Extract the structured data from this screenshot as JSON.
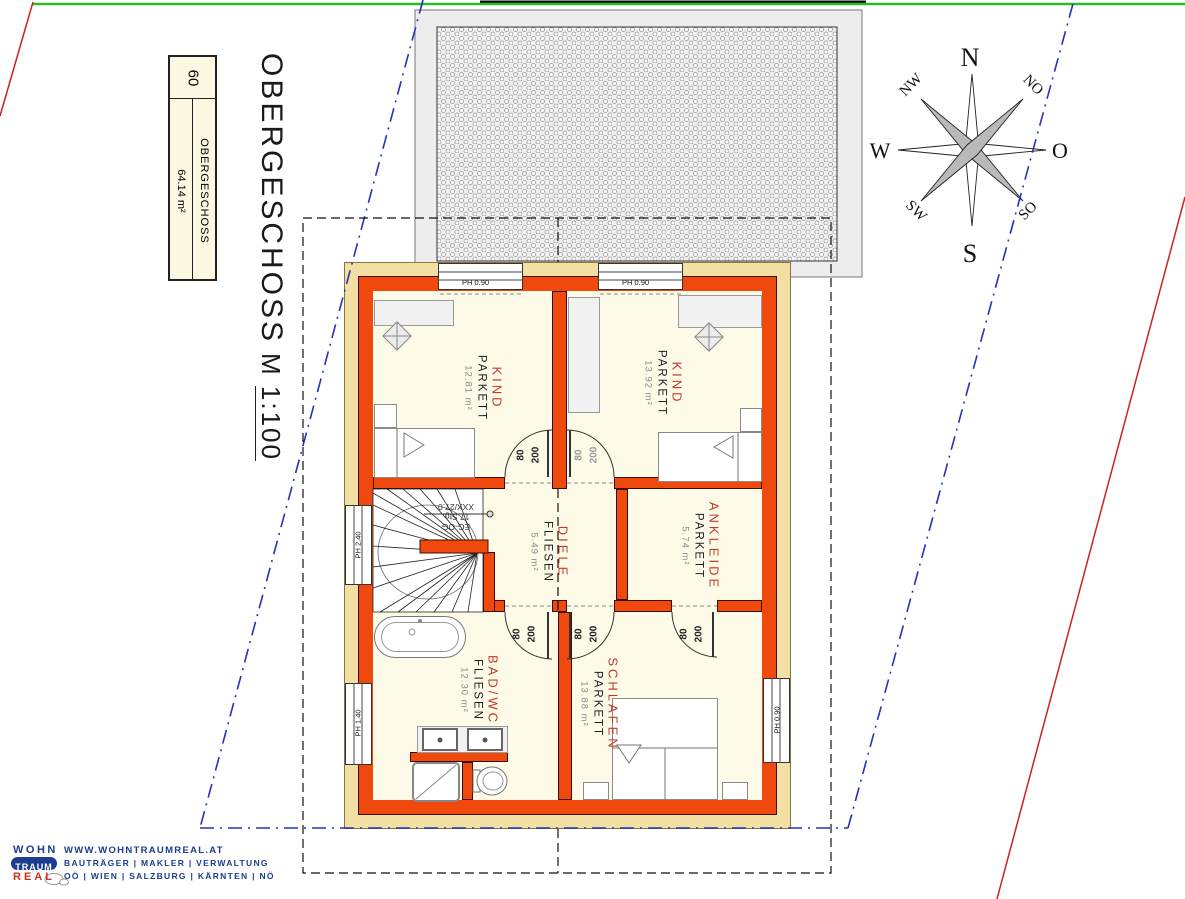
{
  "page": {
    "big_title": "OBERGESCHOSS",
    "scale_prefix": "M ",
    "scale_value": "1:100"
  },
  "title_box": {
    "number": "60",
    "name": "OBERGESCHOSS",
    "area": "64.14 m²"
  },
  "rooms": [
    {
      "name": "KIND",
      "material": "PARKETT",
      "area": "12.81 m²"
    },
    {
      "name": "KIND",
      "material": "PARKETT",
      "area": "13.92 m²"
    },
    {
      "name": "DIELE",
      "material": "FLIESEN",
      "area": "5.49 m²"
    },
    {
      "name": "ANKLEIDE",
      "material": "PARKETT",
      "area": "5.74 m²"
    },
    {
      "name": "BAD/WC",
      "material": "FLIESEN",
      "area": "12.30 m²"
    },
    {
      "name": "SCHLAFEN",
      "material": "PARKETT",
      "area": "13.88 m²"
    }
  ],
  "windows": [
    {
      "label": "PH 0.90"
    },
    {
      "label": "PH 0.90"
    },
    {
      "label": "PH 2.40"
    },
    {
      "label": "PH 1.40"
    },
    {
      "label": "PH 0.90"
    }
  ],
  "doors": [
    {
      "width": "80",
      "height": "200"
    },
    {
      "width": "80",
      "height": "200"
    },
    {
      "width": "80",
      "height": "200"
    },
    {
      "width": "80",
      "height": "200"
    },
    {
      "width": "80",
      "height": "200"
    }
  ],
  "stairs": {
    "line1": "EG-OG",
    "line2": "17 Stg.",
    "line3": "XXX/27.0"
  },
  "compass": {
    "n": "N",
    "no": "NO",
    "o": "O",
    "so": "SO",
    "s": "S",
    "sw": "SW",
    "w": "W",
    "nw": "NW"
  },
  "footer": {
    "logo_line1": "WOHN",
    "logo_line2": "TRAUM",
    "logo_line3": "REAL",
    "website": "WWW.WOHNTRAUMREAL.AT",
    "services": "BAUTRÄGER | MAKLER | VERWALTUNG",
    "regions": "OÖ | WIEN | SALZBURG | KÄRNTEN | NÖ"
  },
  "colors": {
    "wall": "#F0490E",
    "wall_outer_band": "#F2DFA4",
    "floor": "#FDFBE8",
    "room_label_red": "#C03A2B",
    "line_green": "#2DB82D",
    "line_red": "#CC2222",
    "line_blue": "#2233BB",
    "roof_fill": "#EDEDED",
    "logo_navy": "#1B3C8F",
    "logo_red": "#D42B1E"
  }
}
